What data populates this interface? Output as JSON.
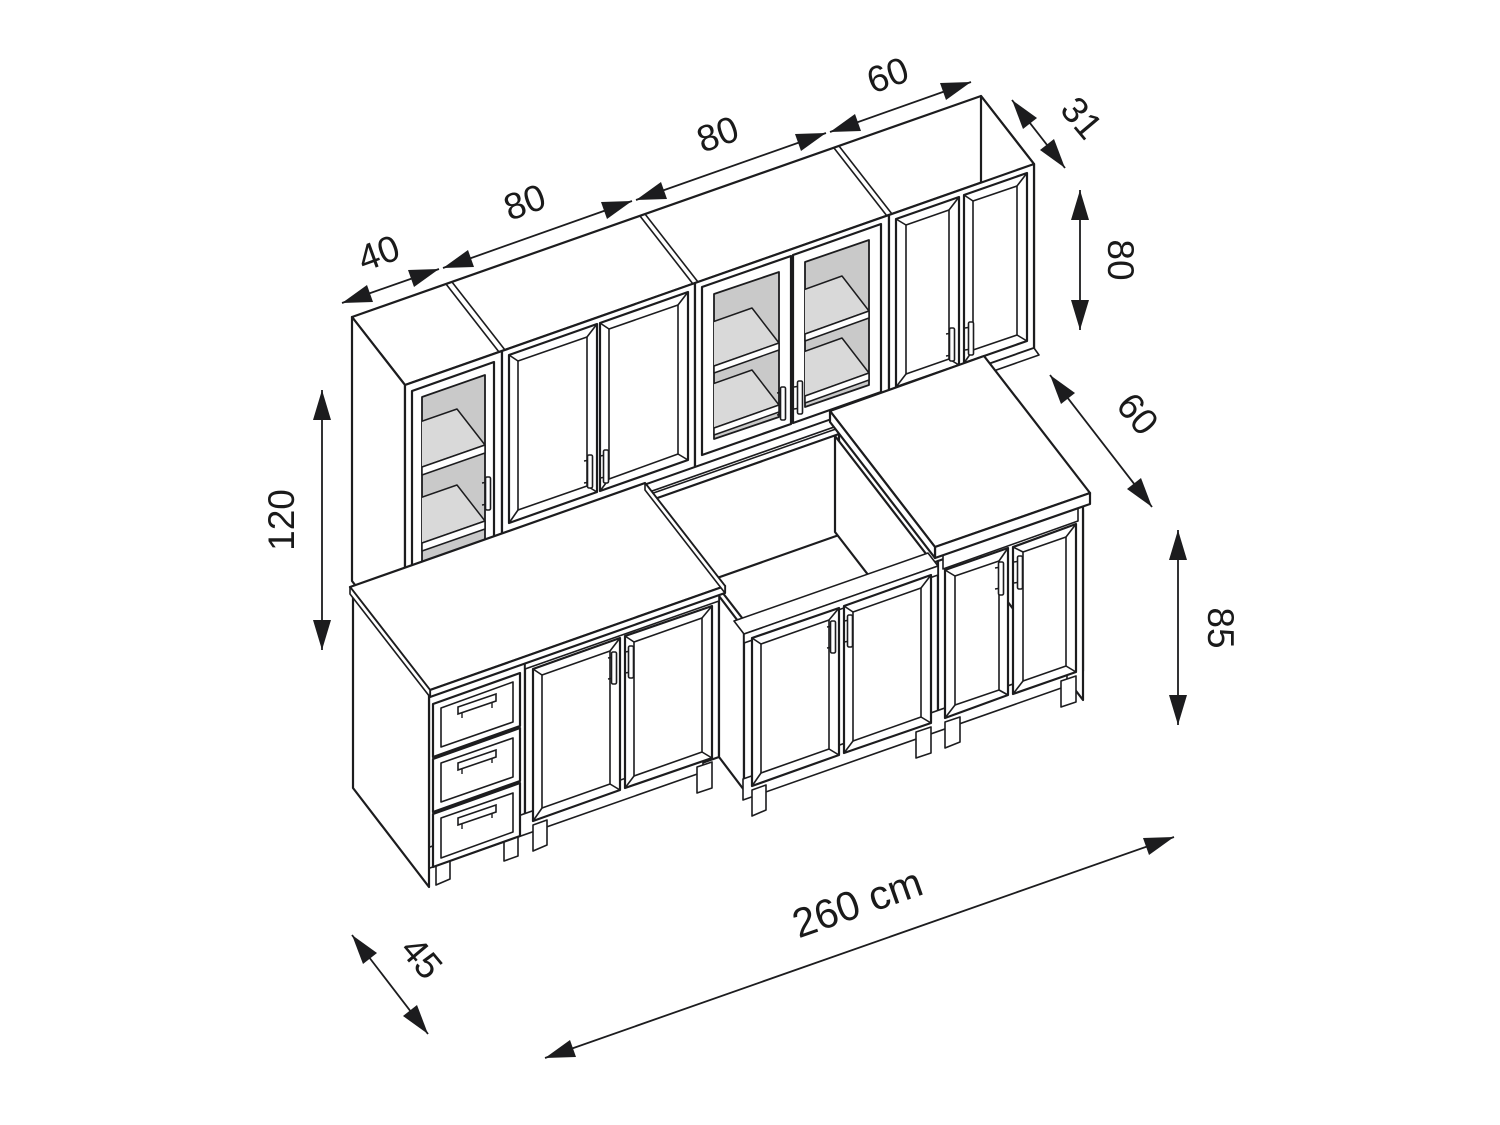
{
  "diagram": {
    "title": "Kitchen cabinet set isometric dimension drawing",
    "unit": "cm",
    "labels": {
      "wall_widths": [
        "40",
        "80",
        "80",
        "60"
      ],
      "wall_depth": "31",
      "wall_height": "80",
      "tall_cabinet_height": "120",
      "base_depth": "60",
      "base_height": "85",
      "drawer_unit_depth": "45",
      "total_width": "260 cm"
    },
    "colors": {
      "line": "#1c1c1e",
      "interior_grey": "#c9c9c9",
      "shelf_grey": "#d9d9d9",
      "background": "#ffffff"
    }
  }
}
